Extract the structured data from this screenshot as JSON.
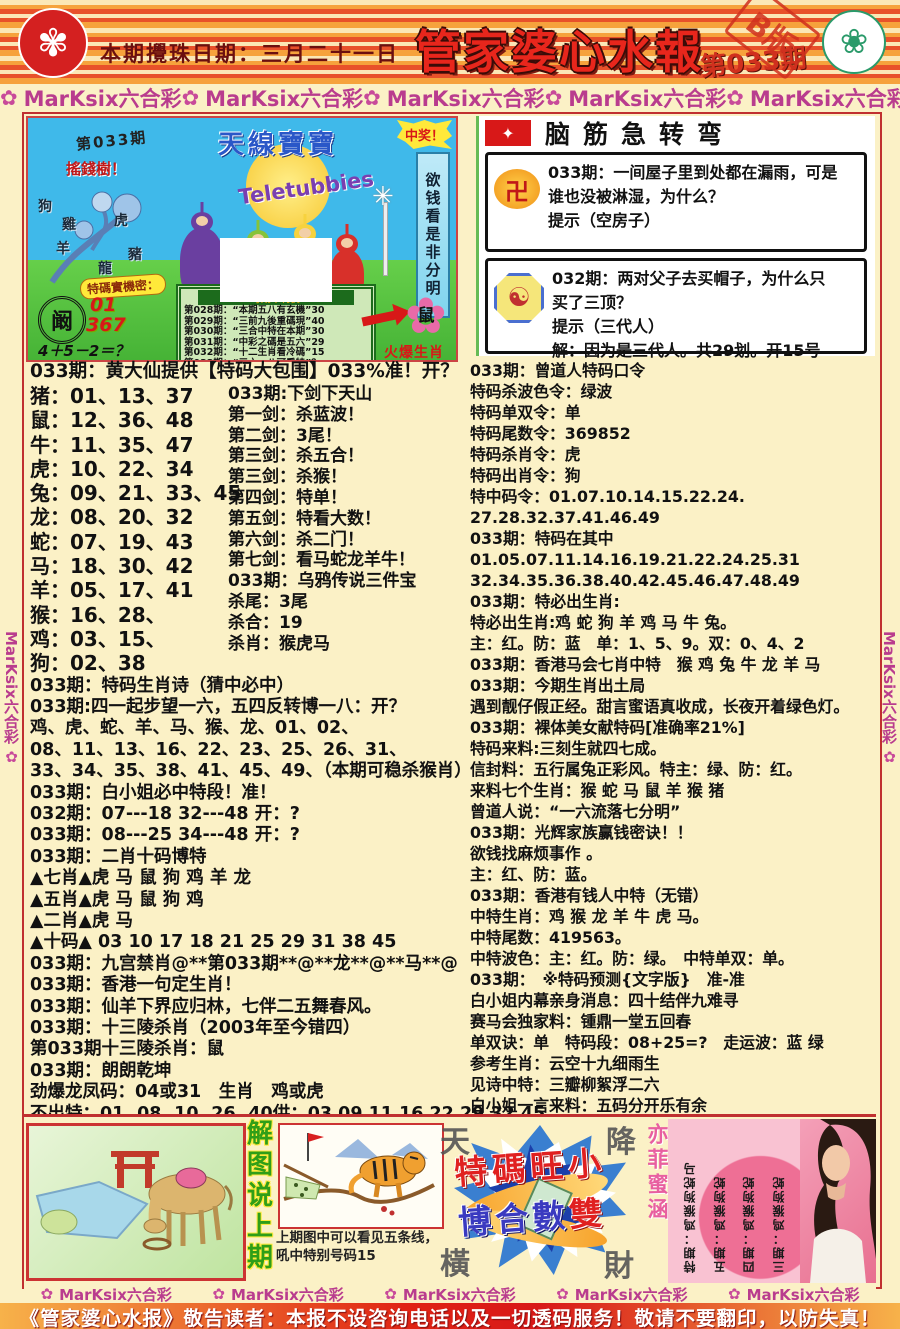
{
  "header": {
    "draw_date": "本期攪珠日期：三月二十一日",
    "title": "管家婆心水報",
    "issue": "第033期",
    "edition": "B版",
    "hk_emblem_glyph": "✾",
    "macau_emblem_glyph": "❀"
  },
  "brand": {
    "label": "MarKsix六合彩",
    "flower": "✿",
    "top_items": [
      "MarKsix六合彩",
      "MarKsix六合彩",
      "MarKsix六合彩",
      "MarKsix六合彩",
      "MarKsix六合彩"
    ],
    "bottom_items": [
      "MarKsix六合彩",
      "MarKsix六合彩",
      "MarKsix六合彩",
      "MarKsix六合彩",
      "MarKsix六合彩"
    ],
    "rail_items": [
      "MarKsix六合彩",
      "MarKsix六合彩",
      "MarKsix六合彩",
      "MarKsix六合彩",
      "MarKsix六合彩",
      "MarKsix六合彩"
    ]
  },
  "teletubbies": {
    "issue": "第033期",
    "money_tree": "搖錢樹！",
    "tree_chars": [
      "狗",
      "雞",
      "羊",
      "虎",
      "龍",
      "豬"
    ],
    "show_title": "天線寶寶",
    "logo": "Teletubbies",
    "win_burst": "中奖！",
    "side_banner": "欲钱看是非分明",
    "secret_label": "特碼實機密：",
    "seal_char": "阚",
    "seal_num1": "01",
    "seal_num2": "367",
    "formula": "4＋5－2＝？",
    "plaque_title": "每期中特詩",
    "plaque_rows": [
      "第028期：“本期五八有玄機”30",
      "第029期：“三前九後重碼現”40",
      "第030期：“三合中特在本期”30",
      "第031期：“中彩之碼是五六”29",
      "第032期：“十二生肖看冷碼”15",
      "第033期：“三六一八可看特”？"
    ],
    "windmill_glyph": "✳",
    "hot_flower_glyph": "✿",
    "hot_char": "鼠",
    "hot_label": "火爆生肖"
  },
  "riddle": {
    "title": "脑筋急转弯",
    "icon_glyph": "✦",
    "box1_icon": "卍",
    "box2_icon": "☯",
    "box1_lines": [
      "033期：一间屋子里到处都在漏雨，可是",
      "谁也没被淋湿，为什么？",
      "提示（空房子）"
    ],
    "box2_lines": [
      "032期：两对父子去买帽子，为什么只",
      "买了三顶？",
      "提示（三代人）",
      "解：因为是三代人。共29划。开15号"
    ]
  },
  "left_col": {
    "heading": "033期：黄大仙提供【特码大包围】033%准！开？",
    "zodiac_list": [
      "猪：01、13、37",
      "鼠：12、36、48",
      "牛：11、35、47",
      "虎：10、22、34",
      "兔：09、21、33、45",
      "龙：08、20、32",
      "蛇：07、19、43",
      "马：18、30、42",
      "羊：05、17、41",
      "猴：16、28、",
      "鸡：03、15、",
      "狗：02、38"
    ],
    "sword_list": [
      "033期:下剑下天山",
      "第一剑：杀蓝波！",
      "第二剑：3尾！",
      "第三剑：杀五合！",
      "第三剑：杀猴！",
      "第四剑：特单！",
      "第五剑：特看大数！",
      "第六剑：杀二门！",
      "第七剑：看马蛇龙羊牛！",
      " ",
      "033期：乌鸦传说三件宝",
      "杀尾：3尾",
      "杀合：19",
      "杀肖：猴虎马"
    ],
    "lines": [
      "033期：特码生肖诗（猜中必中）",
      "033期:四一起步望一六，五四反转博一八：开？",
      "鸡、虎、蛇、羊、马、猴、龙、01、02、",
      "08、11、13、16、22、23、25、26、31、",
      "33、34、35、38、41、45、49、（本期可稳杀猴肖）",
      "033期：白小姐必中特段！准！",
      "032期：07---18 32---48 开：?",
      "033期：08---25 34---48 开：?",
      "033期：二肖十码博特",
      "▲七肖▲虎 马 鼠 狗 鸡 羊 龙",
      "▲五肖▲虎 马 鼠 狗 鸡",
      "▲二肖▲虎 马",
      "▲十码▲ 03 10 17 18 21 25 29 31 38 45",
      "033期：九宫禁肖@**第033期**@**龙**@**马**@",
      "033期：香港一句定生肖！",
      "033期：仙羊下界应归林，七伴二五舞春风。",
      "033期：十三陵杀肖（2003年至今错四）",
      "第033期十三陵杀肖：鼠",
      "033期：朗朗乾坤",
      "劲爆龙凤码：04或31　生肖　鸡或虎",
      "不出特：01, 08, 10, 26, 40供：03 09 11 16 22 29 32 45"
    ]
  },
  "right_col": {
    "lines": [
      "033期：曾道人特码口令",
      "特码杀波色令：绿波",
      "特码单双令：单",
      "特码尾数令：369852",
      "特码杀肖令：虎",
      "特码出肖令：狗",
      "特中码令：01.07.10.14.15.22.24.",
      "27.28.32.37.41.46.49",
      "033期：特码在其中",
      "01.05.07.11.14.16.19.21.22.24.25.31",
      "32.34.35.36.38.40.42.45.46.47.48.49",
      "033期：特必出生肖:",
      "特必出生肖:鸡 蛇 狗 羊 鸡 马 牛 兔。",
      "主：红。防：蓝　单：1、5、9。双：0、4、2",
      "033期：香港马会七肖中特　猴 鸡 兔 牛 龙 羊 马",
      "033期：今期生肖出土局",
      "遇到靓仔假正经。甜言蜜语真收成，长夜开着绿色灯。",
      "033期：裸体美女献特码[准确率21%]",
      "特码来料:三刻生就四七成。",
      "信封料：五行属兔正彩风。特主：绿、防：红。",
      "来料七个生肖：猴 蛇 马 鼠 羊 猴 猪",
      "曾道人说：“一六流落七分明”",
      "033期：光辉家族赢钱密诀！！",
      "欲钱找麻烦事作 。",
      "主：红、防：蓝。",
      "033期：香港有钱人中特（无错）",
      "中特生肖：鸡 猴 龙 羊 牛 虎 马。",
      "中特尾数：419563。",
      "中特波色：主：红。防：绿。　中特单双：单。",
      "033期：　※特码预测{文字版}　准-准",
      "白小姐内幕亲身消息：四十结伴九难寻",
      "赛马会独家料：锺鼎一堂五回春",
      "单双诀：单　特码段：08+25=?　走运波：蓝 绿",
      "参考生肖：云空十九细雨生",
      "见诗中特：三瓣柳絮浮二六",
      "白小姐一言来料：五码分开乐有余"
    ]
  },
  "bottom": {
    "explain_chars": [
      "解",
      "图",
      "说",
      "上",
      "期"
    ],
    "tiger_caption1": "上期图中可以看见五条线，",
    "tiger_caption2": "吼中特别号码15",
    "corner_tl": "天",
    "corner_tr": "降",
    "corner_bl": "橫",
    "corner_br": "財",
    "slogan1": "特碼旺小",
    "slogan2a": "博合數",
    "slogan2b": "雙",
    "girl_name": "亦菲蜜涵",
    "pink_columns": [
      "三期：鸡猴狗蛇",
      "四期：鸡猴狗蛇",
      "五期：鸡猴狗蛇",
      "特期：鸡猴狗蛇马"
    ]
  },
  "footer": {
    "disclaimer": "《管家婆心水报》敬告读者：本报不设咨询电话以及一切透码服务！敬请不要翻印，以防失真！"
  }
}
